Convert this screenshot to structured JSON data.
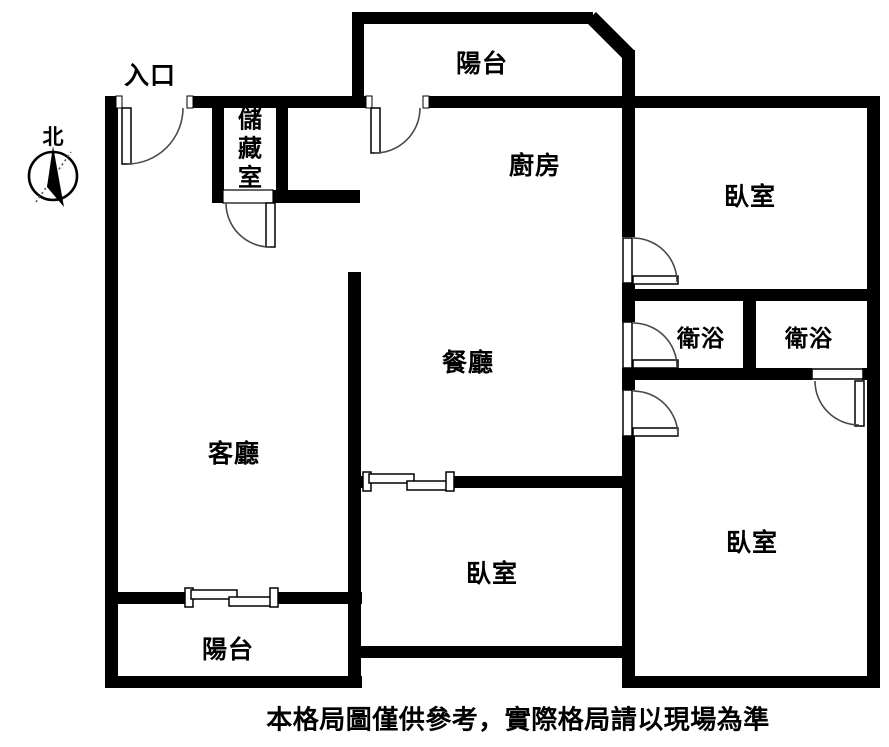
{
  "caption": "本格局圖僅供參考，實際格局請以現場為準",
  "compass": {
    "north_label": "北"
  },
  "labels": {
    "entrance": "入口",
    "balcony_top": "陽台",
    "storage": "儲藏室",
    "kitchen": "廚房",
    "bedroom_top_right": "臥室",
    "bath_left": "衛浴",
    "bath_right": "衛浴",
    "dining": "餐廳",
    "living": "客廳",
    "bedroom_bottom_middle": "臥室",
    "bedroom_bottom_right": "臥室",
    "balcony_bottom": "陽台"
  },
  "colors": {
    "walls": "#000000",
    "background": "#ffffff",
    "text": "#000000"
  }
}
